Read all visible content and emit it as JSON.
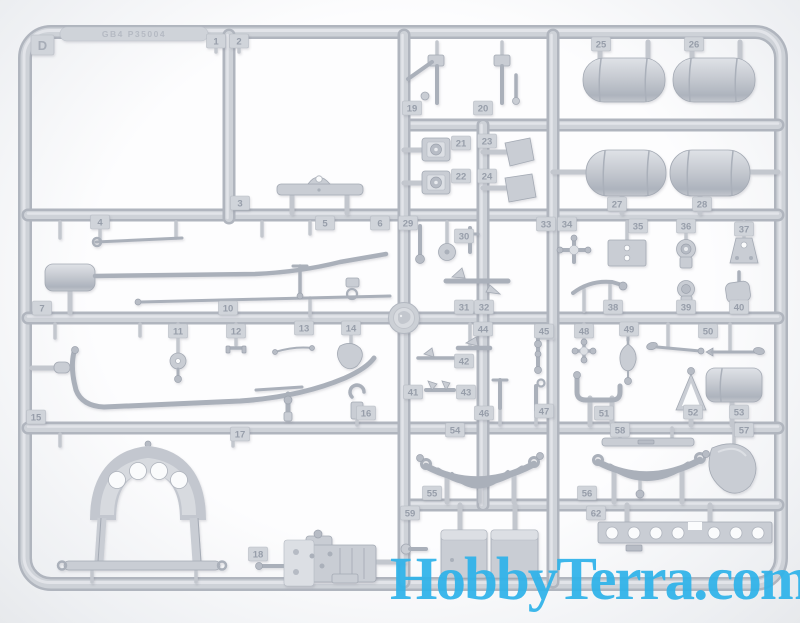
{
  "image": {
    "subject": "gray plastic scale-model sprue frame with numbered parts",
    "colors": {
      "plastic_base": "#c9cdd4",
      "plastic_shadow": "#a9aeb8",
      "plastic_highlight": "#e2e4e9",
      "background": "#f4f6f8"
    }
  },
  "watermark": {
    "text": "HobbyTerra.com",
    "color": "#2fb3ea"
  },
  "sprue": {
    "letter_tag": "D",
    "mold_text": "GB4 P35004",
    "part_tags": [
      {
        "label": "1",
        "x": 216,
        "y": 41
      },
      {
        "label": "2",
        "x": 239,
        "y": 41
      },
      {
        "label": "3",
        "x": 240,
        "y": 203
      },
      {
        "label": "4",
        "x": 100,
        "y": 222
      },
      {
        "label": "5",
        "x": 325,
        "y": 223
      },
      {
        "label": "6",
        "x": 380,
        "y": 223
      },
      {
        "label": "7",
        "x": 42,
        "y": 308
      },
      {
        "label": "10",
        "x": 228,
        "y": 308
      },
      {
        "label": "11",
        "x": 178,
        "y": 331
      },
      {
        "label": "12",
        "x": 236,
        "y": 331
      },
      {
        "label": "13",
        "x": 304,
        "y": 328
      },
      {
        "label": "14",
        "x": 351,
        "y": 328
      },
      {
        "label": "15",
        "x": 36,
        "y": 417
      },
      {
        "label": "16",
        "x": 366,
        "y": 413
      },
      {
        "label": "17",
        "x": 240,
        "y": 434
      },
      {
        "label": "18",
        "x": 258,
        "y": 554
      },
      {
        "label": "19",
        "x": 412,
        "y": 108
      },
      {
        "label": "20",
        "x": 483,
        "y": 108
      },
      {
        "label": "21",
        "x": 461,
        "y": 143
      },
      {
        "label": "22",
        "x": 461,
        "y": 176
      },
      {
        "label": "23",
        "x": 487,
        "y": 141
      },
      {
        "label": "24",
        "x": 487,
        "y": 176
      },
      {
        "label": "25",
        "x": 601,
        "y": 44
      },
      {
        "label": "26",
        "x": 694,
        "y": 44
      },
      {
        "label": "27",
        "x": 617,
        "y": 204
      },
      {
        "label": "28",
        "x": 702,
        "y": 204
      },
      {
        "label": "29",
        "x": 408,
        "y": 223
      },
      {
        "label": "30",
        "x": 464,
        "y": 236
      },
      {
        "label": "31",
        "x": 464,
        "y": 307
      },
      {
        "label": "32",
        "x": 484,
        "y": 307
      },
      {
        "label": "33",
        "x": 546,
        "y": 224
      },
      {
        "label": "34",
        "x": 567,
        "y": 224
      },
      {
        "label": "35",
        "x": 638,
        "y": 226
      },
      {
        "label": "36",
        "x": 686,
        "y": 226
      },
      {
        "label": "37",
        "x": 744,
        "y": 229
      },
      {
        "label": "38",
        "x": 613,
        "y": 307
      },
      {
        "label": "39",
        "x": 686,
        "y": 307
      },
      {
        "label": "40",
        "x": 739,
        "y": 307
      },
      {
        "label": "41",
        "x": 413,
        "y": 392
      },
      {
        "label": "42",
        "x": 464,
        "y": 361
      },
      {
        "label": "43",
        "x": 466,
        "y": 392
      },
      {
        "label": "44",
        "x": 483,
        "y": 329
      },
      {
        "label": "45",
        "x": 544,
        "y": 331
      },
      {
        "label": "46",
        "x": 484,
        "y": 413
      },
      {
        "label": "47",
        "x": 544,
        "y": 411
      },
      {
        "label": "48",
        "x": 584,
        "y": 331
      },
      {
        "label": "49",
        "x": 629,
        "y": 329
      },
      {
        "label": "50",
        "x": 708,
        "y": 331
      },
      {
        "label": "51",
        "x": 604,
        "y": 413
      },
      {
        "label": "52",
        "x": 693,
        "y": 412
      },
      {
        "label": "53",
        "x": 739,
        "y": 412
      },
      {
        "label": "54",
        "x": 455,
        "y": 430
      },
      {
        "label": "55",
        "x": 432,
        "y": 493
      },
      {
        "label": "56",
        "x": 587,
        "y": 493
      },
      {
        "label": "57",
        "x": 744,
        "y": 430
      },
      {
        "label": "58",
        "x": 620,
        "y": 430
      },
      {
        "label": "59",
        "x": 410,
        "y": 513
      },
      {
        "label": "62",
        "x": 596,
        "y": 513
      }
    ]
  }
}
